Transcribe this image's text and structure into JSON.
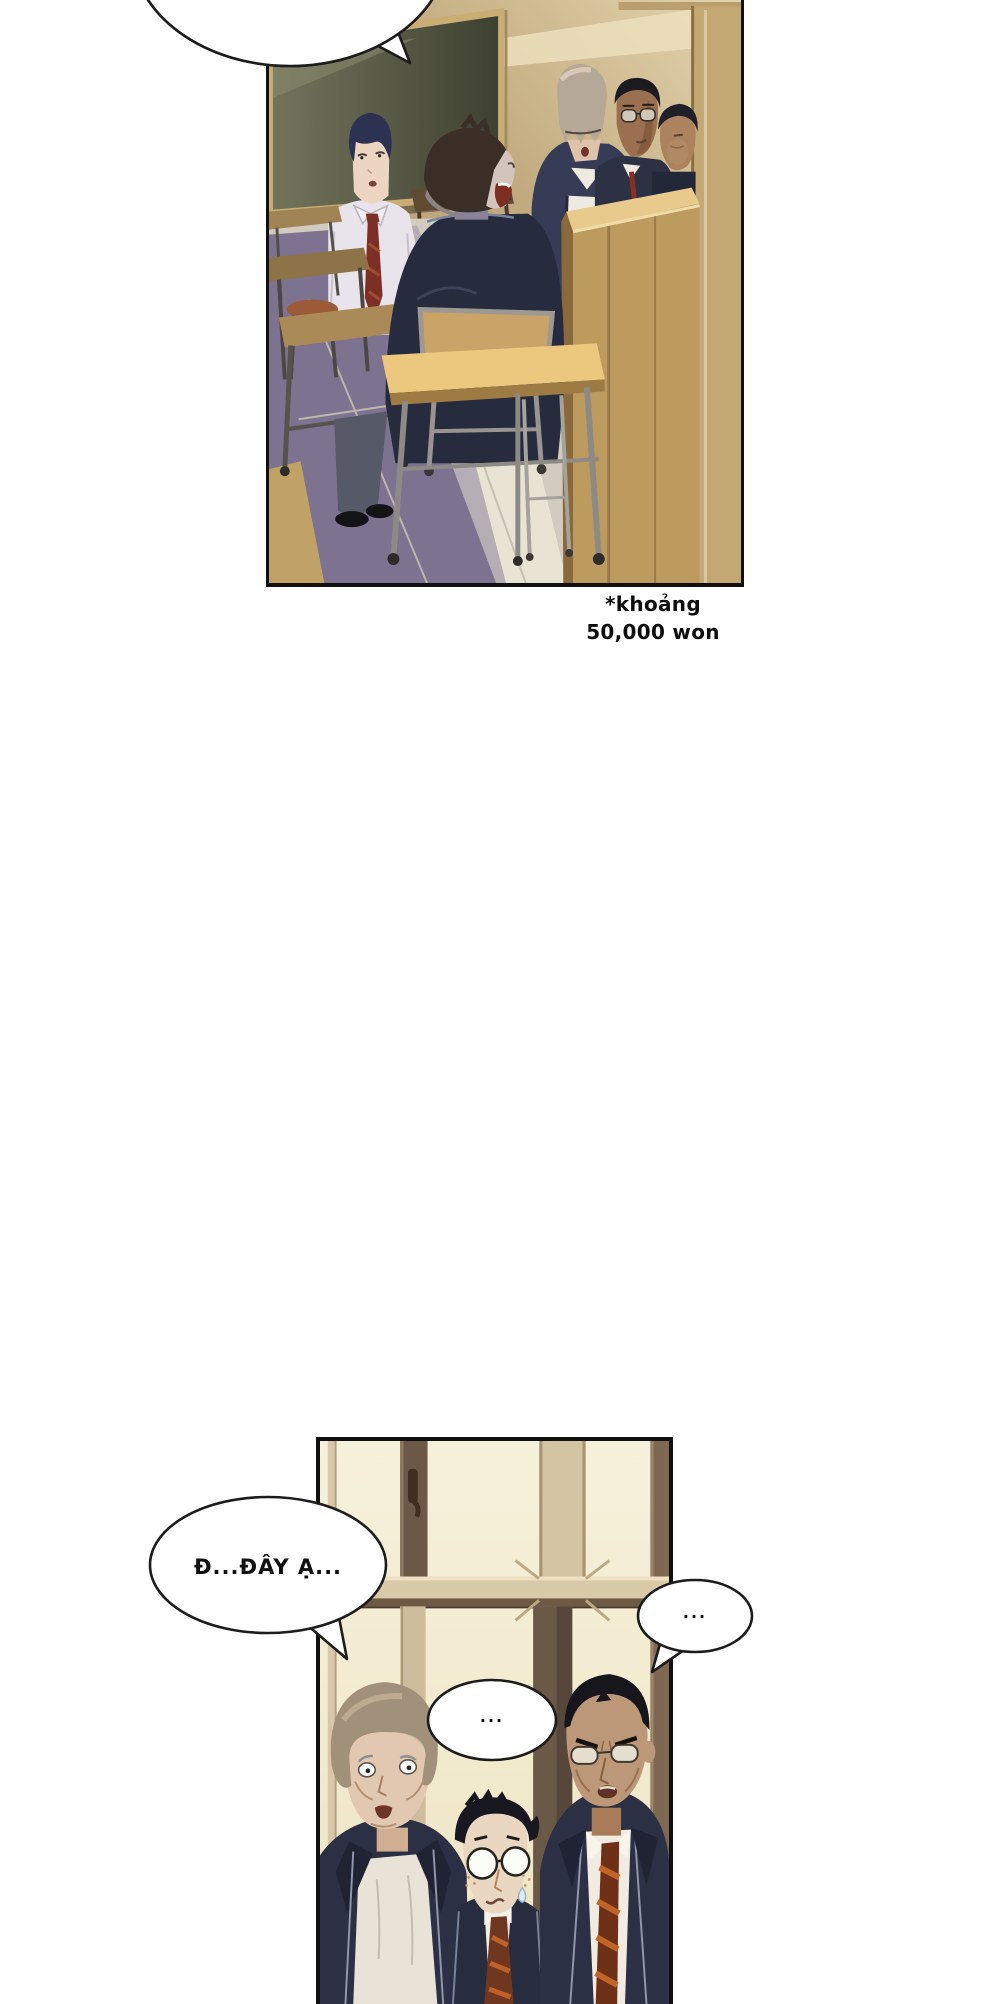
{
  "page": {
    "background": "#ffffff"
  },
  "caption": {
    "line1": "*khoảng",
    "line2": "50,000 won"
  },
  "bubbles": {
    "top_text": "",
    "stammer_text": "Đ...ĐÂY Ạ...",
    "middle_text": "...",
    "right_text": "..."
  },
  "panels": [
    {
      "id": "classroom",
      "alt": "Classroom: standing boy in white shirt and striped tie, seated boy shouting, tall student with hair over his eyes, two students in navy blazers beside a wooden lectern, chalkboard and desks"
    },
    {
      "id": "window",
      "alt": "Three students in navy blazers before a classroom window: nervous heavyset boy, small boy with round glasses and freckles, scowling tall student with glasses"
    }
  ],
  "colors": {
    "panel_border": "#101010",
    "ink": "#1c1c1c",
    "wall_tan": "#b79e74",
    "sunlight": "#ecdfbc",
    "chalkboard": "#4c4f3b",
    "desk_wood": "#ecc87e",
    "lectern_wood": "#bd9a5e",
    "blazer_navy": "#2b3044",
    "tie_maroon": "#7c2f24",
    "window_pane": "#f5f0da",
    "window_frame": "#d8c9a8",
    "floor_shadow": "#7d7390"
  }
}
